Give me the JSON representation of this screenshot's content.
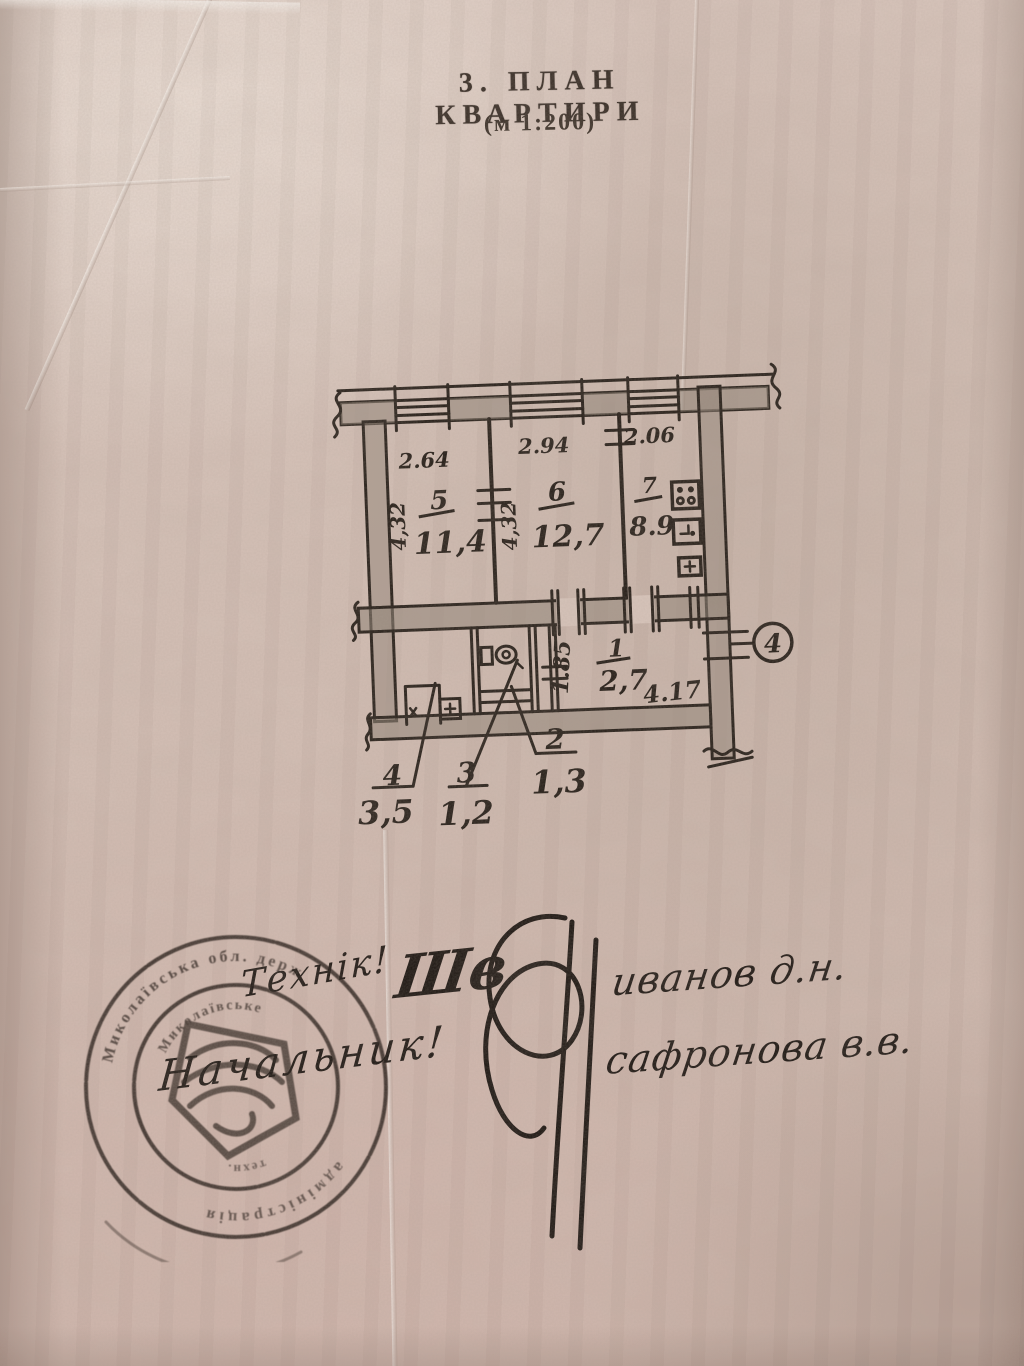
{
  "page": {
    "title": "3.  ПЛАН  КВАРТИРИ",
    "scale_note": "(м  1:200)"
  },
  "plan": {
    "rooms": {
      "r5": {
        "num": "5",
        "area": "11,4"
      },
      "r6": {
        "num": "6",
        "area": "12,7"
      },
      "r7": {
        "num": "7",
        "area": "8.9"
      },
      "r1": {
        "num": "1",
        "area": "2,7"
      },
      "r2": {
        "num": "2",
        "area": "1,3"
      },
      "r3": {
        "num": "3",
        "area": "1,2"
      },
      "r4": {
        "num": "4",
        "area": "3,5"
      }
    },
    "dimensions": {
      "top_width_r5": "2.64",
      "top_width_r6": "2.94",
      "top_width_r7": "2.06",
      "left_height": "4,32",
      "mid_height": "4,32",
      "corridor_height": "1.85",
      "corridor_width": "4.17"
    },
    "callout_number": "4"
  },
  "handwriting": {
    "role_technician": "Технік!",
    "role_chief": "Начальник!",
    "signature_initials": "Шв",
    "surname_1": "иванов д.н.",
    "surname_2": "сафронова в.в."
  },
  "stamp": {
    "ring_text_top": "Миколаївська обл. держ",
    "ring_text_bottom": "адміністрація",
    "inner_ring_text_top": "Миколаївське",
    "inner_ring_text_bottom": "техн."
  },
  "colors": {
    "paper": "#d6c2b8",
    "ink": "#1f1812",
    "wall_shade": "#8d7f73",
    "stamp_ink": "#2b211c"
  }
}
